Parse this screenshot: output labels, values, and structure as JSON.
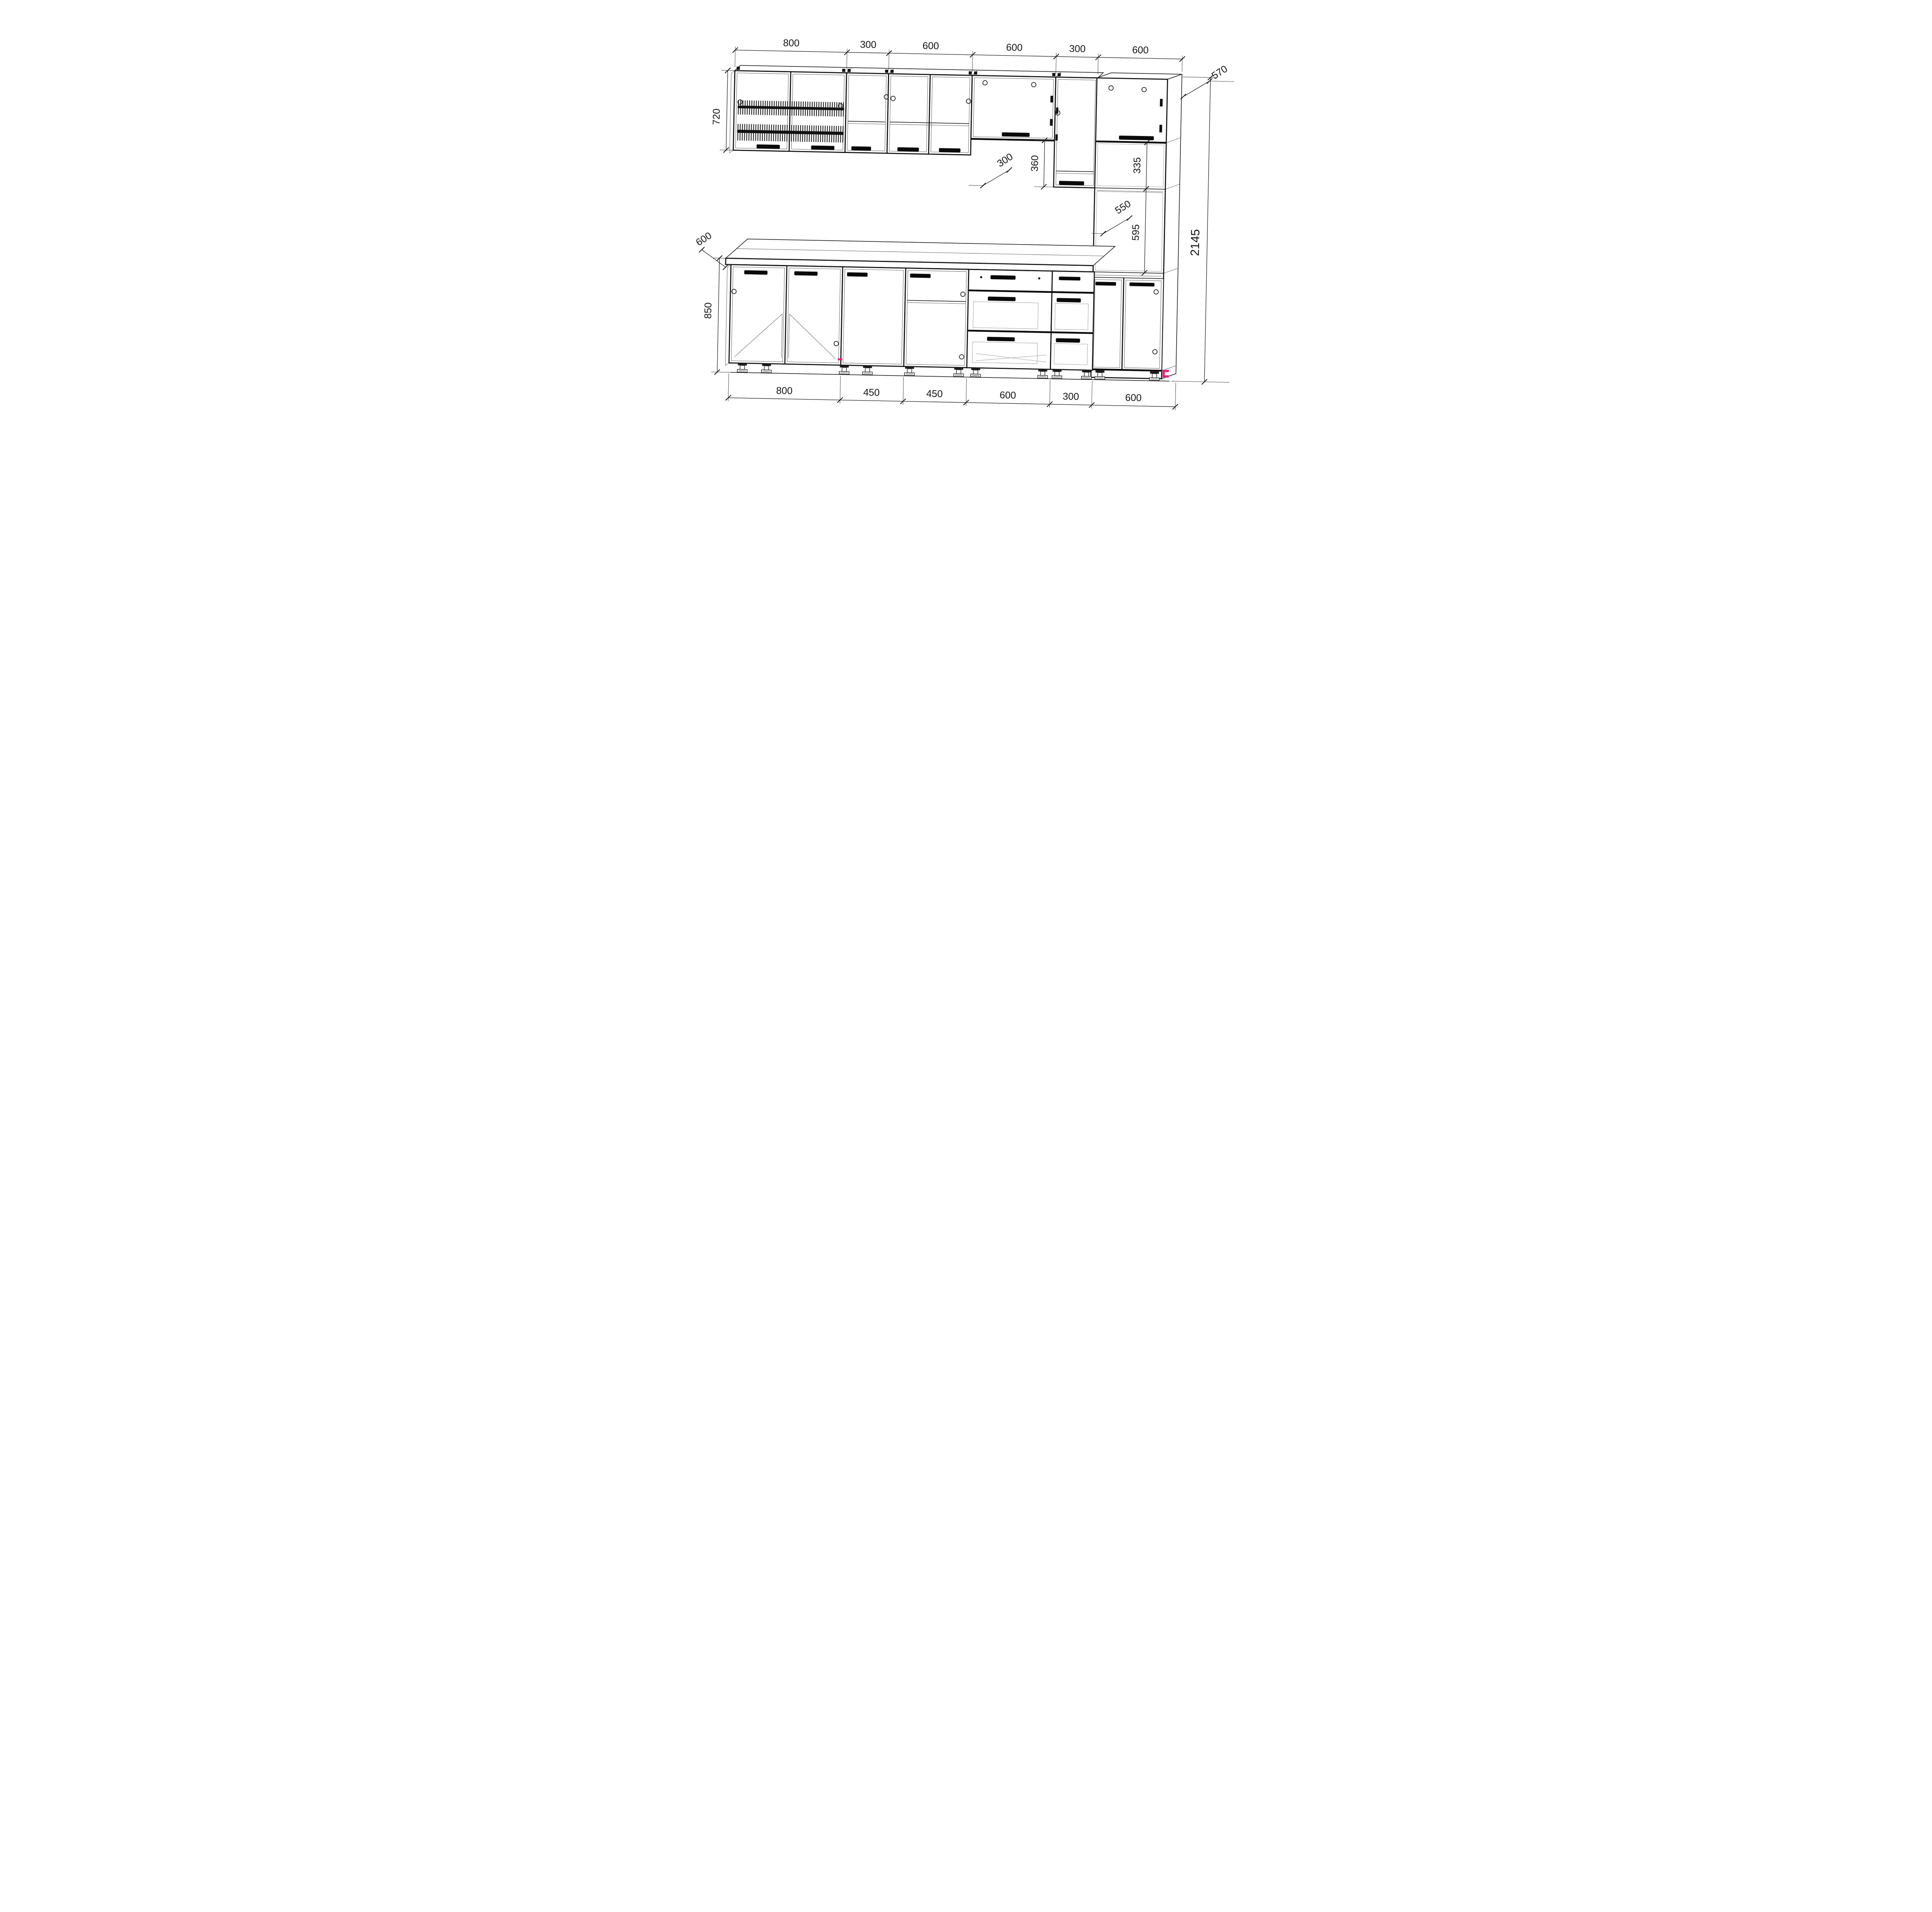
{
  "drawing": {
    "kind": "kitchen-cabinet-set-assembly-drawing",
    "units": "mm",
    "line_color": "#141414",
    "accent_color": "#e81e78",
    "background": "#ffffff"
  },
  "dims": {
    "top": [
      "800",
      "300",
      "600",
      "600",
      "300",
      "600"
    ],
    "bottom": [
      "800",
      "450",
      "450",
      "600",
      "300",
      "600"
    ],
    "left": {
      "upper_cabinet_height": "720",
      "worktop_depth": "600",
      "base_cabinet_height": "850"
    },
    "middle": {
      "flip_cabinet_gap": "360",
      "upper_cabinet_depth": "300"
    },
    "right": {
      "tall_cabinet_depth": "570",
      "upper_niche_height": "335",
      "niche_depth": "550",
      "oven_niche_height": "595",
      "total_height": "2145"
    }
  }
}
